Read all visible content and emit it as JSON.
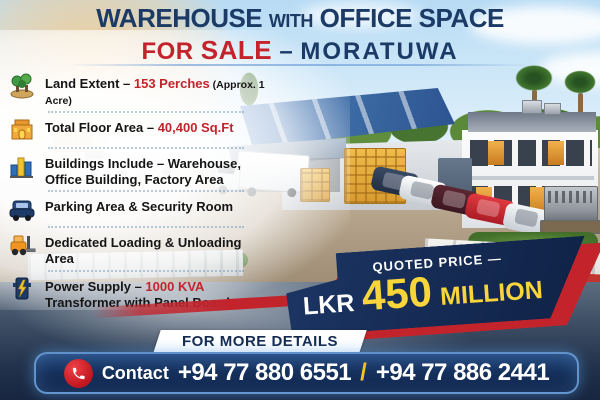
{
  "header": {
    "title_part1": "WAREHOUSE",
    "title_part2": "WITH",
    "title_part3": "OFFICE SPACE",
    "subtitle_for": "FOR",
    "subtitle_sale": "SALE",
    "subtitle_dash": "–",
    "subtitle_city": "MORATUWA"
  },
  "features": [
    {
      "icon": "land-trees-icon",
      "pre": "Land Extent – ",
      "highlight": "153 Perches",
      "note": " (Approx. 1 Acre)",
      "line2": ""
    },
    {
      "icon": "floor-area-building-icon",
      "pre": "Total Floor Area – ",
      "highlight": "40,400 Sq.Ft",
      "note": "",
      "line2": ""
    },
    {
      "icon": "buildings-chart-icon",
      "pre": "Buildings Include – Warehouse,",
      "highlight": "",
      "note": "",
      "line2": "Office Building, Factory Area"
    },
    {
      "icon": "parking-car-icon",
      "pre": "Parking Area & Security Room",
      "highlight": "",
      "note": "",
      "line2": ""
    },
    {
      "icon": "loading-forklift-icon",
      "pre": "Dedicated Loading & Unloading Area",
      "highlight": "",
      "note": "",
      "line2": ""
    },
    {
      "icon": "power-transformer-icon",
      "pre": "Power Supply – ",
      "highlight": "1000 KVA",
      "note": "",
      "line2": "Transformer with Panel Board"
    }
  ],
  "price": {
    "label": "QUOTED PRICE —",
    "currency": "LKR",
    "amount": "450",
    "unit": "MILLION"
  },
  "footer": {
    "details_label": "FOR MORE DETAILS",
    "contact_label": "Contact",
    "phone1": "+94 77 880 6551",
    "separator": "/",
    "phone2": "+94 77 886 2441",
    "phone_icon": "phone-icon"
  },
  "colors": {
    "navy_text": "#1b3a66",
    "red_accent": "#c3242c",
    "banner_navy": "#152a52",
    "price_yellow": "#f8d53a",
    "contact_border_blue": "#6ea5e1"
  }
}
